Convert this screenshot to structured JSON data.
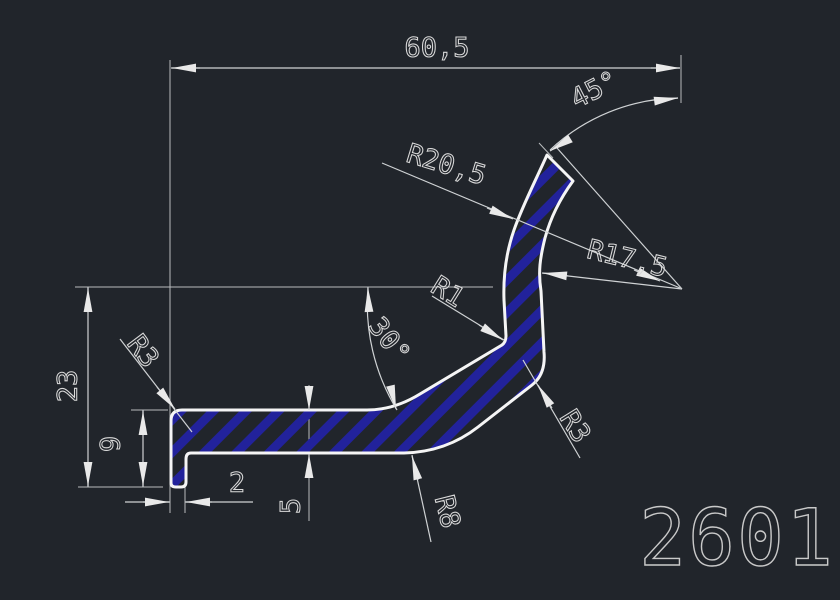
{
  "app": {
    "view": "cad-profile-cross-section-drawing",
    "part_label": "2601"
  },
  "dimensions": {
    "overall_width": "60,5",
    "end_cut_angle": "45°",
    "outer_bend_radius": "R20,5",
    "inner_bend_radius": "R17,5",
    "inner_corner_radius": "R1",
    "slope_angle": "30°",
    "overall_height": "23",
    "top_left_radius": "R3",
    "lip_height": "9",
    "lip_width": "2",
    "wall_thickness": "5",
    "bottom_bend_radius": "R8",
    "outer_corner_radius": "R3"
  },
  "colors": {
    "background": "#21252b",
    "profile_outline": "#f5f5f5",
    "dimension_lines": "#cfd2d4",
    "dimension_text": "#d9d9d9",
    "hatch_blue": "#22229b"
  }
}
